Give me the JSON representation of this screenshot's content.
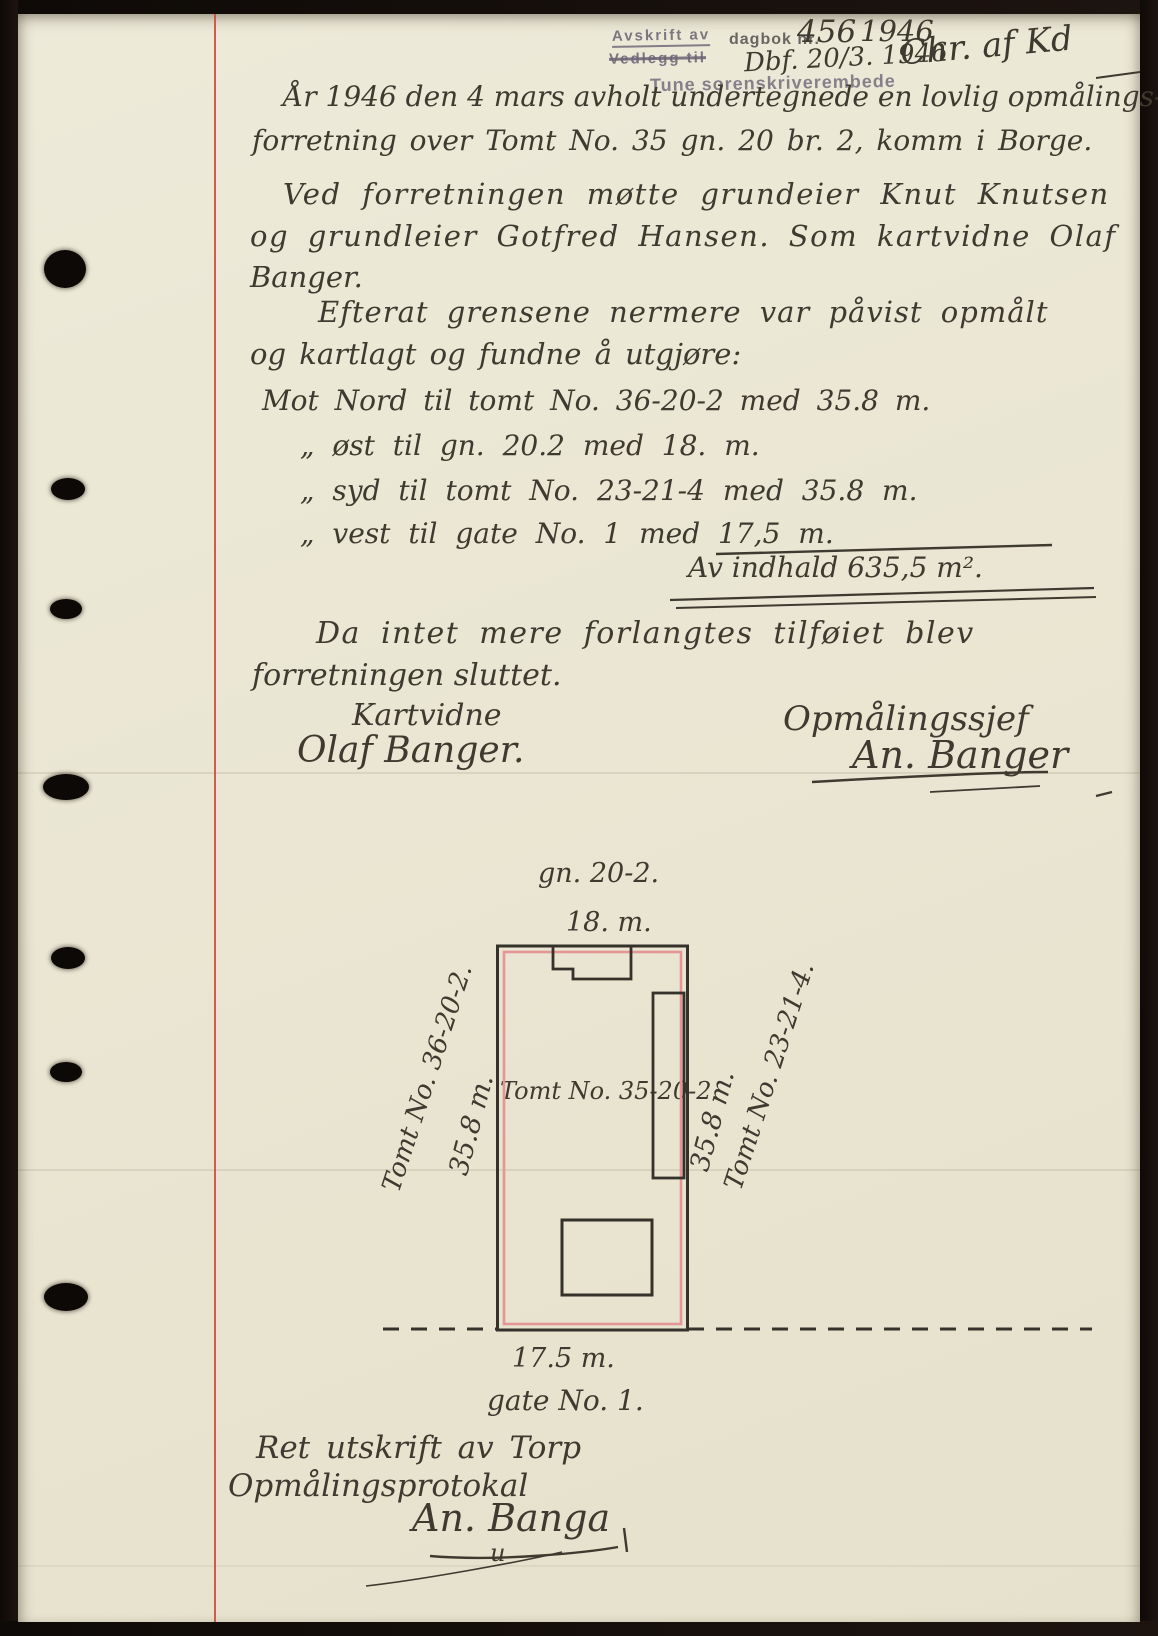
{
  "header": {
    "stamp_avskrift": "Avskrift av",
    "stamp_vedlegg": "Vedlegg til",
    "dagbok_label": "dagbok nr.",
    "dagbok_number": "456",
    "dagbok_year": "1946",
    "filed_note": "Dbf. 20/3. 1946",
    "clerk_initials": "Chr. af Kd",
    "court_stamp": "Tune sorenskriverembede"
  },
  "body": {
    "lines": [
      "År 1946 den 4 mars avholt undertegnede en lovlig opmålings-",
      "forretning over Tomt No. 35 gn. 20 br. 2, komm i Borge.",
      "Ved forretningen møtte grundeier Knut Knutsen",
      "og grundleier Gotfred Hansen. Som kartvidne Olaf",
      "Banger.",
      "Efterat grensene nermere var påvist opmålt",
      "og kartlagt og fundne å utgjøre:",
      "Mot Nord til tomt No. 36-20-2 med 35.8 m.",
      "„  øst til gn. 20.2 med 18. m.",
      "„  syd til tomt No. 23-21-4 med 35.8 m.",
      "„  vest til gate No. 1 med 17,5 m.",
      "Av indhald 635,5 m².",
      "Da intet mere forlangtes tilføiet blev",
      "forretningen sluttet."
    ],
    "signatures": {
      "witness_title": "Kartvidne",
      "witness_name": "Olaf Banger.",
      "surveyor_title": "Opmålingssjef",
      "surveyor_name": "An. Banger"
    }
  },
  "diagram": {
    "area_label": "gn. 20-2.",
    "top_dimension": "18. m.",
    "left_neighbor": "Tomt No. 36-20-2.",
    "left_dimension": "35.8 m.",
    "parcel_label": "Tomt No. 35-20-2.",
    "right_dimension": "35.8 m.",
    "right_neighbor": "Tomt No. 23-21-4.",
    "bottom_dimension": "17.5 m.",
    "street_label": "gate No. 1.",
    "measurements": {
      "north_m": 35.8,
      "east_m": 18,
      "south_m": 35.8,
      "west_m": 17.5,
      "area_m2": 635.5
    }
  },
  "footer": {
    "certification_line1": "Ret utskrift av Torp",
    "certification_line2": "Opmålingsprotokal",
    "signature": "An. Banga",
    "correction_mark": "u"
  },
  "colors": {
    "paper": "#eae6d3",
    "ink": "#3e3a30",
    "stamp_ink": "#6a6472",
    "margin_line": "#c94a38",
    "survey_line": "#e59694",
    "scan_background": "#14100c"
  }
}
